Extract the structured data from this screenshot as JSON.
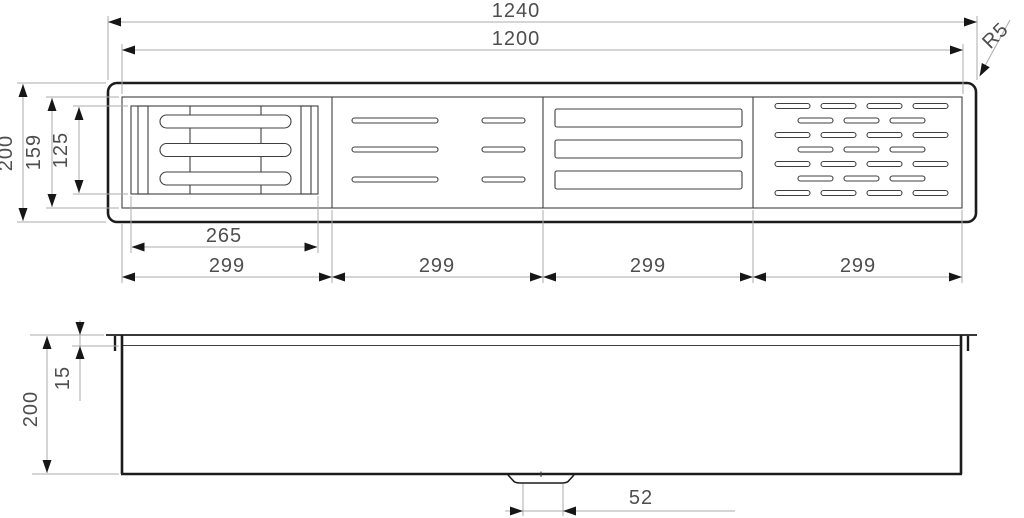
{
  "views": {
    "top": {
      "dims": {
        "overall_length": "1240",
        "inner_length": "1200",
        "corner_radius": "R5",
        "overall_width": "200",
        "inner_width": "159",
        "rack_width": "125",
        "rack_length": "265",
        "sections": [
          "299",
          "299",
          "299",
          "299"
        ]
      }
    },
    "side": {
      "dims": {
        "rim_height": "15",
        "overall_height": "200",
        "drain_width": "52"
      }
    }
  },
  "colors": {
    "geometry_dark": "#1c1c1c",
    "geometry_thin": "#3f3f3f",
    "dimension_line": "#ababab",
    "arrowhead": "#161616",
    "text": "#4e4e4e",
    "background": "#ffffff"
  }
}
